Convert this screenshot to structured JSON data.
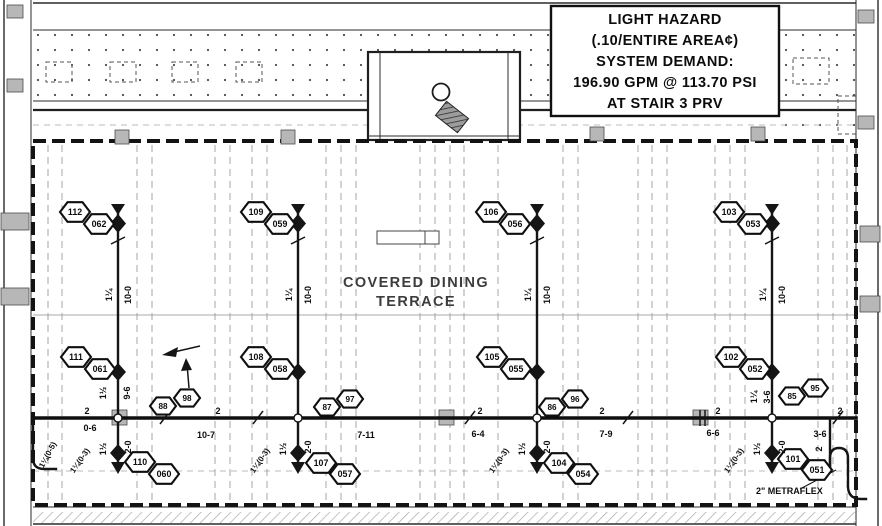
{
  "colors": {
    "ink": "#151515",
    "paper": "#ffffff",
    "grid": "#9b9b9b",
    "column_fill": "#b7b7b7",
    "boundary": "#131313"
  },
  "title_block": {
    "lines": [
      "LIGHT HAZARD",
      "(.10/ENTIRE AREA¢)",
      "SYSTEM DEMAND:",
      "196.90 GPM @ 113.70 PSI",
      "AT STAIR 3 PRV"
    ]
  },
  "labels": {
    "room_line1": "COVERED DINING",
    "room_line2": "TERRACE",
    "metraflex": "2\" METRAFLEX"
  },
  "diagram": {
    "pipes": {
      "main_y": 418,
      "main_x1": 33,
      "main_x2": 856,
      "riser_xs": [
        118,
        298,
        537,
        772
      ]
    },
    "node_tags": [
      {
        "label": "112",
        "x": 75,
        "y": 212,
        "s": "b"
      },
      {
        "label": "062",
        "x": 99,
        "y": 224,
        "s": "b"
      },
      {
        "label": "109",
        "x": 256,
        "y": 212,
        "s": "b"
      },
      {
        "label": "059",
        "x": 280,
        "y": 224,
        "s": "b"
      },
      {
        "label": "106",
        "x": 491,
        "y": 212,
        "s": "b"
      },
      {
        "label": "056",
        "x": 515,
        "y": 224,
        "s": "b"
      },
      {
        "label": "103",
        "x": 729,
        "y": 212,
        "s": "b"
      },
      {
        "label": "053",
        "x": 753,
        "y": 224,
        "s": "b"
      },
      {
        "label": "111",
        "x": 76,
        "y": 357,
        "s": "b"
      },
      {
        "label": "061",
        "x": 100,
        "y": 369,
        "s": "b"
      },
      {
        "label": "108",
        "x": 256,
        "y": 357,
        "s": "b"
      },
      {
        "label": "058",
        "x": 280,
        "y": 369,
        "s": "b"
      },
      {
        "label": "105",
        "x": 492,
        "y": 357,
        "s": "b"
      },
      {
        "label": "055",
        "x": 516,
        "y": 369,
        "s": "b"
      },
      {
        "label": "102",
        "x": 731,
        "y": 357,
        "s": "b"
      },
      {
        "label": "052",
        "x": 755,
        "y": 369,
        "s": "b"
      },
      {
        "label": "88",
        "x": 163,
        "y": 406,
        "s": "sm"
      },
      {
        "label": "98",
        "x": 187,
        "y": 398,
        "s": "sm"
      },
      {
        "label": "87",
        "x": 327,
        "y": 407,
        "s": "sm"
      },
      {
        "label": "97",
        "x": 350,
        "y": 399,
        "s": "sm"
      },
      {
        "label": "86",
        "x": 552,
        "y": 407,
        "s": "sm"
      },
      {
        "label": "96",
        "x": 575,
        "y": 399,
        "s": "sm"
      },
      {
        "label": "85",
        "x": 792,
        "y": 396,
        "s": "sm"
      },
      {
        "label": "95",
        "x": 815,
        "y": 388,
        "s": "sm"
      },
      {
        "label": "110",
        "x": 140,
        "y": 462,
        "s": "b"
      },
      {
        "label": "060",
        "x": 164,
        "y": 474,
        "s": "b"
      },
      {
        "label": "107",
        "x": 321,
        "y": 463,
        "s": "b"
      },
      {
        "label": "057",
        "x": 345,
        "y": 474,
        "s": "b"
      },
      {
        "label": "104",
        "x": 559,
        "y": 463,
        "s": "b"
      },
      {
        "label": "054",
        "x": 583,
        "y": 474,
        "s": "b"
      },
      {
        "label": "101",
        "x": 793,
        "y": 459,
        "s": "b"
      },
      {
        "label": "051",
        "x": 817,
        "y": 470,
        "s": "b"
      }
    ],
    "annotations": [
      {
        "t": "2",
        "x": 87,
        "y": 414
      },
      {
        "t": "2",
        "x": 218,
        "y": 414
      },
      {
        "t": "2",
        "x": 480,
        "y": 414
      },
      {
        "t": "2",
        "x": 602,
        "y": 414
      },
      {
        "t": "2",
        "x": 718,
        "y": 414
      },
      {
        "t": "2",
        "x": 840,
        "y": 414
      },
      {
        "t": "0-6",
        "x": 90,
        "y": 431
      },
      {
        "t": "10-7",
        "x": 206,
        "y": 438
      },
      {
        "t": "7-11",
        "x": 366,
        "y": 438
      },
      {
        "t": "6-4",
        "x": 478,
        "y": 437
      },
      {
        "t": "7-9",
        "x": 606,
        "y": 437
      },
      {
        "t": "6-6",
        "x": 713,
        "y": 436
      },
      {
        "t": "3-6",
        "x": 820,
        "y": 437
      },
      {
        "t": "1¼",
        "x": 112,
        "y": 295,
        "r": -90
      },
      {
        "t": "10-0",
        "x": 131,
        "y": 295,
        "r": -90
      },
      {
        "t": "1¼",
        "x": 292,
        "y": 295,
        "r": -90
      },
      {
        "t": "10-0",
        "x": 311,
        "y": 295,
        "r": -90
      },
      {
        "t": "1¼",
        "x": 531,
        "y": 295,
        "r": -90
      },
      {
        "t": "10-0",
        "x": 550,
        "y": 295,
        "r": -90
      },
      {
        "t": "1¼",
        "x": 766,
        "y": 295,
        "r": -90
      },
      {
        "t": "10-0",
        "x": 785,
        "y": 295,
        "r": -90
      },
      {
        "t": "1½",
        "x": 106,
        "y": 449,
        "r": -90
      },
      {
        "t": "2-0",
        "x": 131,
        "y": 447,
        "r": -90
      },
      {
        "t": "1¼(0-3)",
        "x": 82,
        "y": 462,
        "r": -55,
        "fs": 8
      },
      {
        "t": "1½",
        "x": 286,
        "y": 449,
        "r": -90
      },
      {
        "t": "2-0",
        "x": 311,
        "y": 447,
        "r": -90
      },
      {
        "t": "1¼(0-3)",
        "x": 262,
        "y": 462,
        "r": -55,
        "fs": 8
      },
      {
        "t": "1½",
        "x": 525,
        "y": 449,
        "r": -90
      },
      {
        "t": "2-0",
        "x": 550,
        "y": 447,
        "r": -90
      },
      {
        "t": "1¼(0-3)",
        "x": 501,
        "y": 462,
        "r": -55,
        "fs": 8
      },
      {
        "t": "1½",
        "x": 760,
        "y": 449,
        "r": -90
      },
      {
        "t": "2-0",
        "x": 785,
        "y": 447,
        "r": -90
      },
      {
        "t": "1¼(0-3)",
        "x": 736,
        "y": 462,
        "r": -55,
        "fs": 8
      },
      {
        "t": "1½",
        "x": 106,
        "y": 393,
        "r": -90
      },
      {
        "t": "9-6",
        "x": 130,
        "y": 393,
        "r": -90
      },
      {
        "t": "1¼",
        "x": 757,
        "y": 397,
        "r": -90
      },
      {
        "t": "3-6",
        "x": 770,
        "y": 397,
        "r": -90
      },
      {
        "t": "1¼(0-5)",
        "x": 50,
        "y": 456,
        "r": -62,
        "fs": 8
      },
      {
        "t": "2",
        "x": 822,
        "y": 449,
        "r": -90
      }
    ],
    "grid_x": [
      48,
      62,
      137,
      152,
      215,
      230,
      252,
      267,
      326,
      341,
      356,
      420,
      435,
      450,
      464,
      498,
      563,
      578,
      638,
      652,
      667,
      715,
      730,
      745,
      818,
      833,
      847
    ]
  }
}
